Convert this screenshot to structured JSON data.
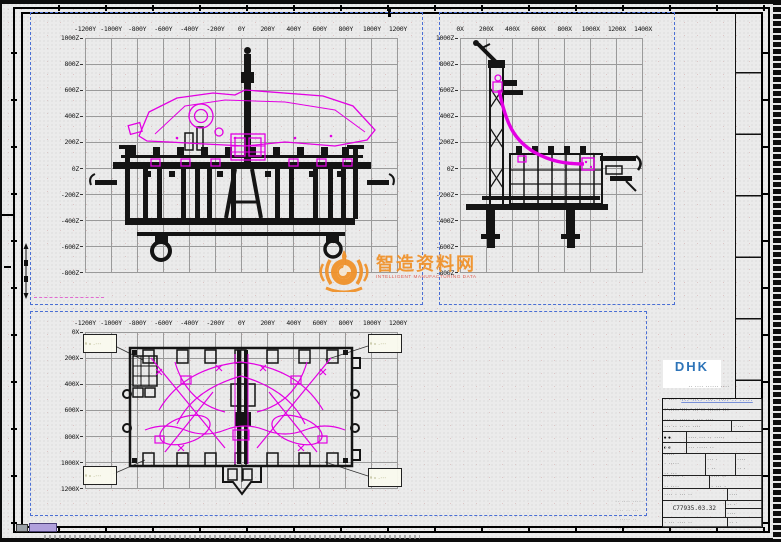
{
  "views": {
    "front": {
      "y_labels": [
        "-1200Y",
        "-1000Y",
        "-800Y",
        "-600Y",
        "-400Y",
        "-200Y",
        "0Y",
        "200Y",
        "400Y",
        "600Y",
        "800Y",
        "1000Y",
        "1200Y"
      ],
      "z_labels": [
        "1000Z",
        "800Z",
        "600Z",
        "400Z",
        "200Z",
        "0Z",
        "-200Z",
        "-400Z",
        "-600Z",
        "-800Z"
      ]
    },
    "side": {
      "x_labels": [
        "0X",
        "200X",
        "400X",
        "600X",
        "800X",
        "1000X",
        "1200X",
        "1400X"
      ],
      "z_labels": [
        "1000Z",
        "800Z",
        "600Z",
        "400Z",
        "200Z",
        "0Z",
        "-200Z",
        "-400Z",
        "-600Z",
        "-800Z"
      ]
    },
    "plan": {
      "y_labels": [
        "-1200Y",
        "-1000Y",
        "-800Y",
        "-600Y",
        "-400Y",
        "-200Y",
        "0Y",
        "200Y",
        "400Y",
        "600Y",
        "800Y",
        "1000Y",
        "1200Y"
      ],
      "x_labels": [
        "0X",
        "200X",
        "400X",
        "600X",
        "800X",
        "1000X",
        "1200X"
      ]
    }
  },
  "coord_box_lines": [
    "X = +···",
    "Y = -···",
    "Z = +···"
  ],
  "watermark": {
    "title": "智造资料网",
    "subtitle": "INTELLIGENT MANUFACTURING DATA"
  },
  "vendor": {
    "logo_text": "DHK",
    "logo_caption": "·· ···· ······ ····",
    "link_text": "··· ···· ···· ···· ·· ·····"
  },
  "title_block": {
    "note1": "· ···· ··· ····· ·· ··· ·······",
    "note2": "·· ··· ···· · ····· ··· ·· ···",
    "note3": "· ····· ···· ··· ·· ······ ···",
    "note4": "··· ·· ····· · ··· ····",
    "r3a": "··· ·· ·· ·· ····",
    "r3b": "· ···",
    "r4a": "● ●",
    "r4b": "···· ··· ·· ·····",
    "r5a": "◐ ◐",
    "r5b": "··· ····· ··",
    "r6a1": "·····",
    "r6a2": "· ·····",
    "r6a3": "·· ···",
    "r6b1": "··· ·",
    "r6b2": "· ··",
    "r6c1": "····",
    "r6c2": "·· ·",
    "r7a1": "··· ··· ·",
    "r7a2": "·· ····",
    "r7b1": "···· ··",
    "r7b2": "· ··· ·",
    "r8a": "···· · ··· ··",
    "r8b": "····",
    "drawing_no": "C77935.03.32",
    "r9b1": "·· ·",
    "r9b2": "····",
    "r10a": "· ··· ···· ··",
    "r10b": "·· ·"
  },
  "footer_stamp": [
    "·· ···· ·····",
    "···· ·· ···",
    "· ····· ··",
    "··· ··"
  ]
}
